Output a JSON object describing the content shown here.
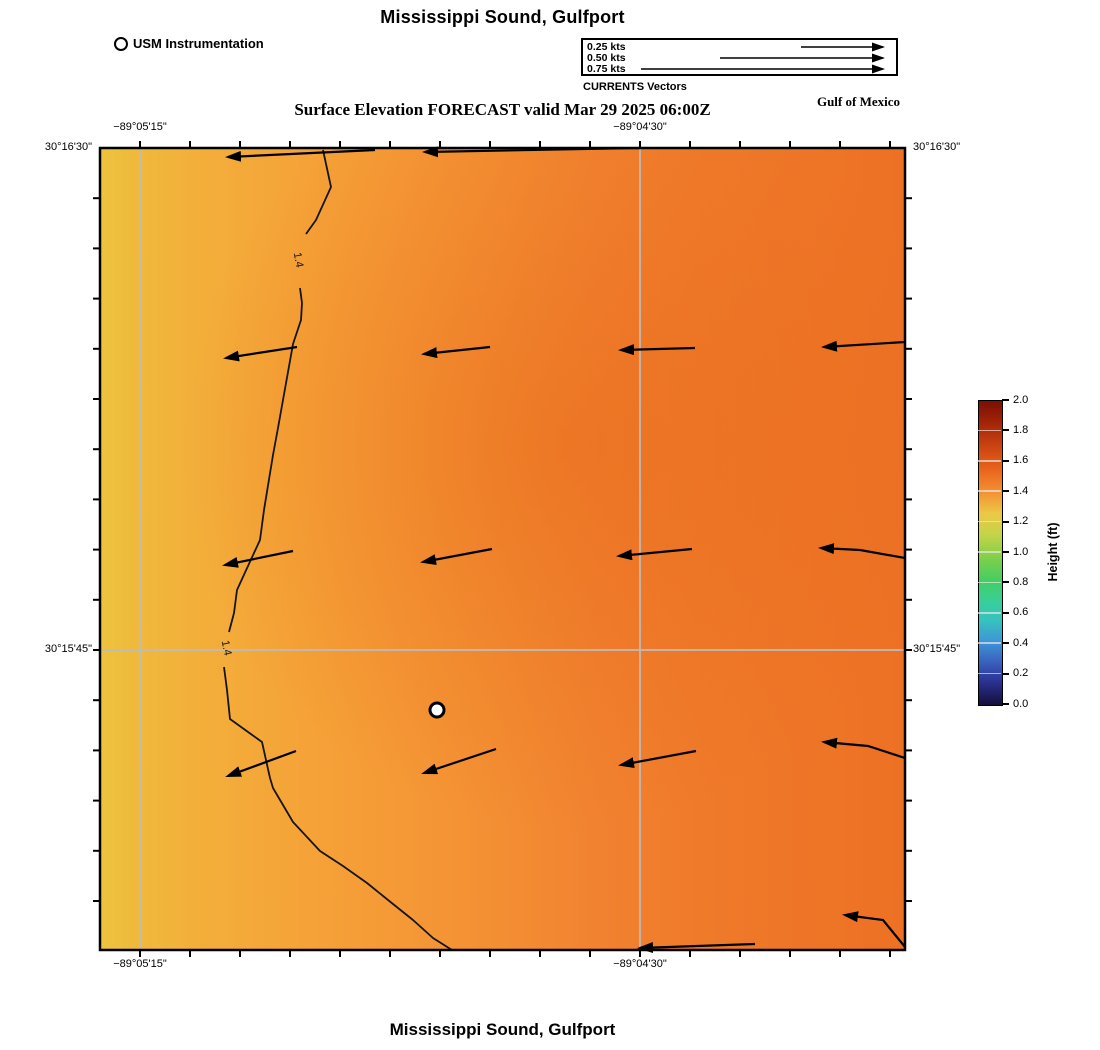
{
  "page": {
    "top_title": "Mississippi Sound, Gulfport",
    "subtitle": "Surface Elevation FORECAST valid Mar 29 2025 06:00Z",
    "region_label": "Gulf of Mexico",
    "bottom_title": "Mississippi Sound, Gulfport"
  },
  "instrument_legend": {
    "label": "USM Instrumentation",
    "marker": "circle-icon"
  },
  "vector_legend": {
    "title": "CURRENTS Vectors",
    "line_to": 300,
    "entries": [
      {
        "label": "0.25 kts",
        "line_from": 218
      },
      {
        "label": "0.50 kts",
        "line_from": 137
      },
      {
        "label": "0.75 kts",
        "line_from": 58
      }
    ]
  },
  "colorbar": {
    "label": "Height (ft)",
    "ticks": [
      "2.0",
      "1.8",
      "1.6",
      "1.4",
      "1.2",
      "1.0",
      "0.8",
      "0.6",
      "0.4",
      "0.2",
      "0.0"
    ],
    "stops": [
      [
        "#7a0f03",
        0
      ],
      [
        "#a82708",
        8
      ],
      [
        "#cf4814",
        16
      ],
      [
        "#ea671e",
        23
      ],
      [
        "#f29133",
        30
      ],
      [
        "#ecc847",
        37
      ],
      [
        "#c3d449",
        44
      ],
      [
        "#7ccf4b",
        52
      ],
      [
        "#45ce62",
        59
      ],
      [
        "#38cf9a",
        66
      ],
      [
        "#36c3bd",
        72
      ],
      [
        "#3e96d6",
        79
      ],
      [
        "#3a60bd",
        86
      ],
      [
        "#2b3494",
        92
      ],
      [
        "#1b1752",
        98
      ],
      [
        "#140f38",
        100
      ]
    ]
  },
  "chart_data": {
    "type": "heatmap",
    "title": "Mississippi Sound, Gulfport",
    "subtitle": "Surface Elevation FORECAST valid Mar 29 2025 06:00Z",
    "field": "surface_elevation",
    "units": "ft",
    "value_range": [
      0.0,
      2.0
    ],
    "map_px": {
      "left": 100,
      "top": 148,
      "width": 805,
      "height": 802
    },
    "axis_labels": [
      {
        "edge": "top",
        "pos": 40,
        "text": "−89°05'15\""
      },
      {
        "edge": "top",
        "pos": 540,
        "text": "−89°04'30\""
      },
      {
        "edge": "bottom",
        "pos": 40,
        "text": "−89°05'15\""
      },
      {
        "edge": "bottom",
        "pos": 540,
        "text": "−89°04'30\""
      },
      {
        "edge": "left",
        "pos": 0,
        "text": "30°16'30\""
      },
      {
        "edge": "left",
        "pos": 502,
        "text": "30°15'45\""
      },
      {
        "edge": "right",
        "pos": 0,
        "text": "30°16'30\""
      },
      {
        "edge": "right",
        "pos": 502,
        "text": "30°15'45\""
      }
    ],
    "gridlines": {
      "vertical": [
        40,
        540
      ],
      "horizontal": [
        502
      ]
    },
    "ticks": {
      "x_start": 40,
      "x_step": 50,
      "x_count": 16,
      "y_start": 50.2,
      "y_step": 50.2,
      "y_count": 15,
      "length": 7
    },
    "gradient": {
      "direction": "west-to-east",
      "stops": [
        [
          "#ecc33e",
          0
        ],
        [
          "#f0b83c",
          5
        ],
        [
          "#f3ae3a",
          13
        ],
        [
          "#f5a338",
          25
        ],
        [
          "#f59936",
          37
        ],
        [
          "#f38e33",
          50
        ],
        [
          "#f18230",
          62
        ],
        [
          "#ef7a2a",
          75
        ],
        [
          "#ee7527",
          87
        ],
        [
          "#ed7124",
          100
        ]
      ],
      "dark_patch": {
        "cx": 0.58,
        "cy": 0.37,
        "r": 0.48,
        "color_in": "rgba(231,102,24,0.5)",
        "color_mid": "rgba(231,102,24,0.22)"
      }
    },
    "contour": {
      "level": "1.4",
      "segments": [
        [
          [
            223,
            2
          ],
          [
            231,
            39
          ],
          [
            216,
            72
          ],
          [
            206,
            86
          ]
        ],
        [
          [
            200,
            140
          ],
          [
            202,
            155
          ],
          [
            201,
            172
          ],
          [
            193,
            196
          ],
          [
            178,
            280
          ],
          [
            173,
            307
          ],
          [
            164,
            362
          ],
          [
            160,
            392
          ],
          [
            148,
            418
          ],
          [
            137,
            442
          ],
          [
            134,
            465
          ],
          [
            129,
            484
          ]
        ],
        [
          [
            124,
            519
          ],
          [
            127,
            542
          ],
          [
            130,
            571
          ],
          [
            162,
            594
          ],
          [
            170,
            630
          ],
          [
            173,
            640
          ],
          [
            193,
            674
          ],
          [
            220,
            703
          ],
          [
            243,
            718
          ],
          [
            267,
            735
          ],
          [
            293,
            756
          ],
          [
            313,
            772
          ],
          [
            333,
            790
          ],
          [
            352,
            802
          ]
        ]
      ],
      "labels": [
        {
          "x": 198,
          "y": 112,
          "rot": 80
        },
        {
          "x": 126,
          "y": 500,
          "rot": 78
        }
      ]
    },
    "vectors": {
      "units": "kts",
      "arrows": [
        {
          "pts": [
            [
              275,
              2
            ],
            [
              128,
              9
            ]
          ]
        },
        {
          "pts": [
            [
              540,
              0
            ],
            [
              325,
              4
            ]
          ]
        },
        {
          "pts": [
            [
              197,
              199
            ],
            [
              126,
              210
            ]
          ]
        },
        {
          "pts": [
            [
              390,
              199
            ],
            [
              324,
              206
            ]
          ]
        },
        {
          "pts": [
            [
              595,
              200
            ],
            [
              521,
              202
            ]
          ]
        },
        {
          "pts": [
            [
              805,
              194
            ],
            [
              724,
              199
            ]
          ]
        },
        {
          "pts": [
            [
              193,
              403
            ],
            [
              125,
              417
            ]
          ]
        },
        {
          "pts": [
            [
              392,
              401
            ],
            [
              323,
              414
            ]
          ]
        },
        {
          "pts": [
            [
              592,
              401
            ],
            [
              519,
              408
            ]
          ]
        },
        {
          "pts": [
            [
              805,
              410
            ],
            [
              760,
              402
            ],
            [
              721,
              400
            ]
          ]
        },
        {
          "pts": [
            [
              196,
              603
            ],
            [
              128,
              628
            ]
          ]
        },
        {
          "pts": [
            [
              396,
              601
            ],
            [
              324,
              625
            ]
          ]
        },
        {
          "pts": [
            [
              596,
              603
            ],
            [
              521,
              617
            ]
          ]
        },
        {
          "pts": [
            [
              805,
              610
            ],
            [
              768,
              598
            ],
            [
              724,
              594
            ]
          ]
        },
        {
          "pts": [
            [
              655,
              796
            ],
            [
              540,
              800
            ]
          ]
        },
        {
          "pts": [
            [
              805,
              799
            ],
            [
              783,
              772
            ],
            [
              745,
              767
            ]
          ]
        }
      ]
    },
    "station_marker": {
      "x": 337,
      "y": 562,
      "r": 7
    }
  }
}
